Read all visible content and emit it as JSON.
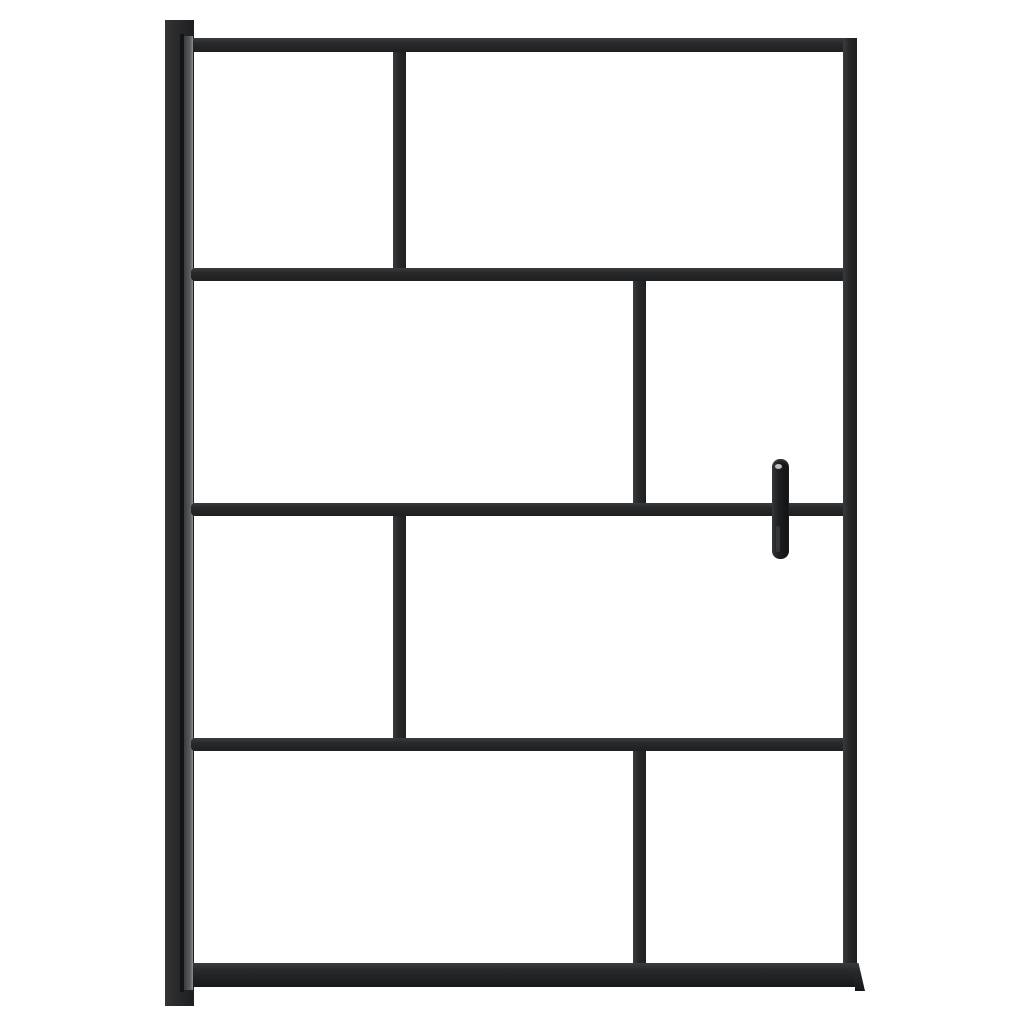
{
  "scene": {
    "description": "Front-view product photo of a walk-in shower screen: black aluminium frame with eight clear glass panels in a staggered brick grid, left wall mounting profile, vertical door handle on the right, white studio background",
    "colors": {
      "background": "#ffffff",
      "frame": "#28292b",
      "frame_light": "#3a3b3e",
      "frame_dark": "#1e1f21",
      "post_highlight": "#8b8e91",
      "handle": "#1c1d1f"
    }
  },
  "geometry": {
    "canvas": {
      "width": 1024,
      "height": 1024
    },
    "members": [
      {
        "name": "wall-profile-post",
        "fill": "post",
        "x": 165,
        "y": 20,
        "w": 29,
        "h": 986
      },
      {
        "name": "post-seam-line",
        "fill": "seam",
        "x": 180,
        "y": 34,
        "w": 4,
        "h": 958
      },
      {
        "name": "post-highlight-strip",
        "fill": "strip",
        "x": 184,
        "y": 36,
        "w": 9,
        "h": 954
      },
      {
        "name": "frame-top-rail",
        "fill": "bar-h",
        "x": 193,
        "y": 38,
        "w": 664,
        "h": 14
      },
      {
        "name": "frame-right-stile",
        "fill": "bar-v",
        "x": 843,
        "y": 38,
        "w": 14,
        "h": 949
      },
      {
        "name": "glass-divider-h1",
        "fill": "bar-h",
        "x": 191,
        "y": 268,
        "w": 652,
        "h": 13,
        "radius": "4px 0 0 4px"
      },
      {
        "name": "glass-divider-h2",
        "fill": "bar-h",
        "x": 191,
        "y": 503,
        "w": 652,
        "h": 13,
        "radius": "4px 0 0 4px"
      },
      {
        "name": "glass-divider-h3",
        "fill": "bar-h",
        "x": 191,
        "y": 738,
        "w": 652,
        "h": 13,
        "radius": "4px 0 0 4px"
      },
      {
        "name": "glass-divider-v1",
        "fill": "bar-v",
        "x": 393,
        "y": 52,
        "w": 13,
        "h": 216
      },
      {
        "name": "glass-divider-v2",
        "fill": "bar-v",
        "x": 633,
        "y": 281,
        "w": 13,
        "h": 222
      },
      {
        "name": "glass-divider-v3",
        "fill": "bar-v",
        "x": 393,
        "y": 516,
        "w": 13,
        "h": 222
      },
      {
        "name": "glass-divider-v4",
        "fill": "bar-v",
        "x": 633,
        "y": 751,
        "w": 13,
        "h": 212
      },
      {
        "name": "frame-bottom-rail",
        "fill": "bar-thick",
        "x": 193,
        "y": 963,
        "w": 665,
        "h": 24
      },
      {
        "name": "bottom-rail-flare",
        "fill": "bar-thick",
        "x": 855,
        "y": 963,
        "w": 10,
        "h": 28,
        "clip": "polygon(0 0, 35% 0, 100% 100%, 0 100%)"
      }
    ],
    "glass_panels": [
      {
        "name": "glass-panel-r1-left",
        "x": 194,
        "y": 52,
        "w": 199,
        "h": 216
      },
      {
        "name": "glass-panel-r1-right",
        "x": 406,
        "y": 52,
        "w": 437,
        "h": 216
      },
      {
        "name": "glass-panel-r2-left",
        "x": 194,
        "y": 281,
        "w": 439,
        "h": 222
      },
      {
        "name": "glass-panel-r2-right",
        "x": 646,
        "y": 281,
        "w": 197,
        "h": 222
      },
      {
        "name": "glass-panel-r3-left",
        "x": 194,
        "y": 516,
        "w": 199,
        "h": 222
      },
      {
        "name": "glass-panel-r3-right",
        "x": 406,
        "y": 516,
        "w": 437,
        "h": 222
      },
      {
        "name": "glass-panel-r4-left",
        "x": 194,
        "y": 751,
        "w": 439,
        "h": 212
      },
      {
        "name": "glass-panel-r4-right",
        "x": 646,
        "y": 751,
        "w": 197,
        "h": 212
      }
    ],
    "handle": {
      "name": "door-handle",
      "x": 772,
      "y": 459,
      "w": 17,
      "h": 100
    }
  }
}
